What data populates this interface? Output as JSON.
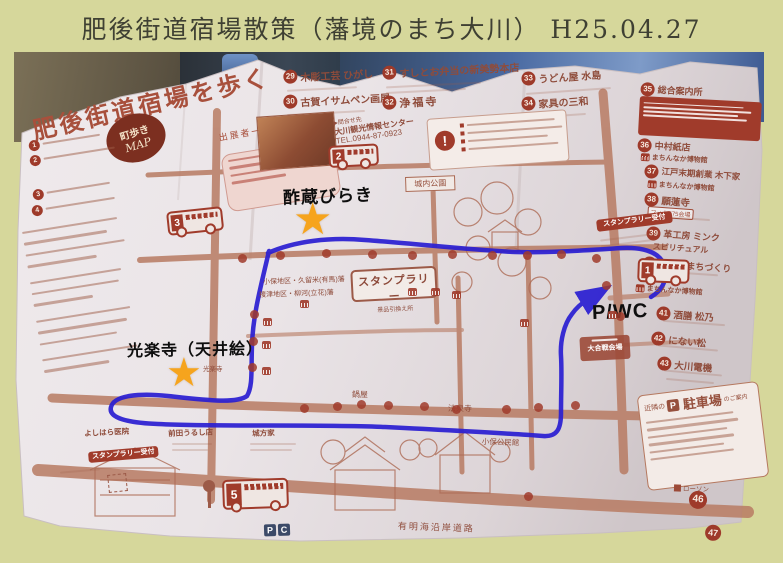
{
  "page_title": "肥後街道宿場散策（藩境のまち大川） H25.04.27",
  "map": {
    "logo_title": "肥後街道宿場を歩く",
    "exhibitors_label": "出展者一覧",
    "badge": {
      "line1": "町歩き",
      "line2": "MAP"
    },
    "contact": {
      "label": "▶問合せ先",
      "name": "大川観光情報センター",
      "tel": "TEL.0944-87-0923"
    },
    "top_list": [
      {
        "no": "29",
        "label": "木彫工芸 ひがし"
      },
      {
        "no": "30",
        "label": "古賀イサムペン画展"
      },
      {
        "no": "31",
        "label": "すしとお弁当の新美勢本店"
      },
      {
        "no": "32",
        "label": "浄福寺"
      },
      {
        "no": "33",
        "label": "うどん屋 水島"
      },
      {
        "no": "34",
        "label": "家具の三和"
      }
    ],
    "left_list": [
      {
        "no": "1"
      },
      {
        "no": "2"
      },
      {
        "no": "3"
      },
      {
        "no": "4"
      }
    ],
    "right_list": [
      {
        "no": "35",
        "label": "総合案内所"
      },
      {
        "no": "36",
        "label": "中村紙店"
      },
      {
        "no": "37",
        "label": "江戸末期創業 木下家"
      },
      {
        "no": "38",
        "label": "願蓮寺"
      },
      {
        "no": "39",
        "label": "革工房 ミンク",
        "sub": "スピリチュアル"
      },
      {
        "no": "40",
        "label": "藩境のまちづくり"
      },
      {
        "no": "41",
        "label": "酒膳 松乃"
      },
      {
        "no": "42",
        "label": "にない松"
      },
      {
        "no": "43",
        "label": "大川電機"
      },
      {
        "no": "44",
        "label": "正覚寺"
      },
      {
        "no": "45",
        "label": "光楽寺"
      },
      {
        "no": "46",
        "label": ""
      },
      {
        "no": "47",
        "label": ""
      }
    ],
    "museum_badge": "まちんなか博物館",
    "stamp_rally_box": {
      "title": "スタンプラリー",
      "subtitle": "景品引換え所"
    },
    "stamp_reception": "スタンプラリー受付",
    "photo575_chip": "フォト575会場",
    "annotations": {
      "szo": "酢蔵びらき",
      "temple": "光楽寺（天井絵）",
      "temple_small": "光楽寺",
      "pwc": "P/WC"
    },
    "map_labels": {
      "josenji": "法泉寺",
      "nabeya": "鍋屋",
      "koho_kominkan": "小保公民館",
      "jonai_koen": "城内公園",
      "ariake_road": "有明海沿岸道路",
      "battle_hall": "大合戦会場",
      "han_north": "小保地区・久留米(有馬)藩",
      "han_south": "榎津地区・柳河(立花)藩",
      "yoshihara": "よしはら医院",
      "maeda": "前田うるし店",
      "jokata": "城方家",
      "lawson": "ローソン"
    },
    "parking_box": {
      "prefix": "近隣の",
      "p": "P",
      "main": "駐車場",
      "suffix": "のご案内"
    },
    "bus_numbers": {
      "b1": "1",
      "b2": "2",
      "b3": "3",
      "b5": "5"
    },
    "pc_letters": {
      "p": "P",
      "c": "C"
    },
    "icons": {
      "star": "★",
      "alert": "!"
    }
  }
}
